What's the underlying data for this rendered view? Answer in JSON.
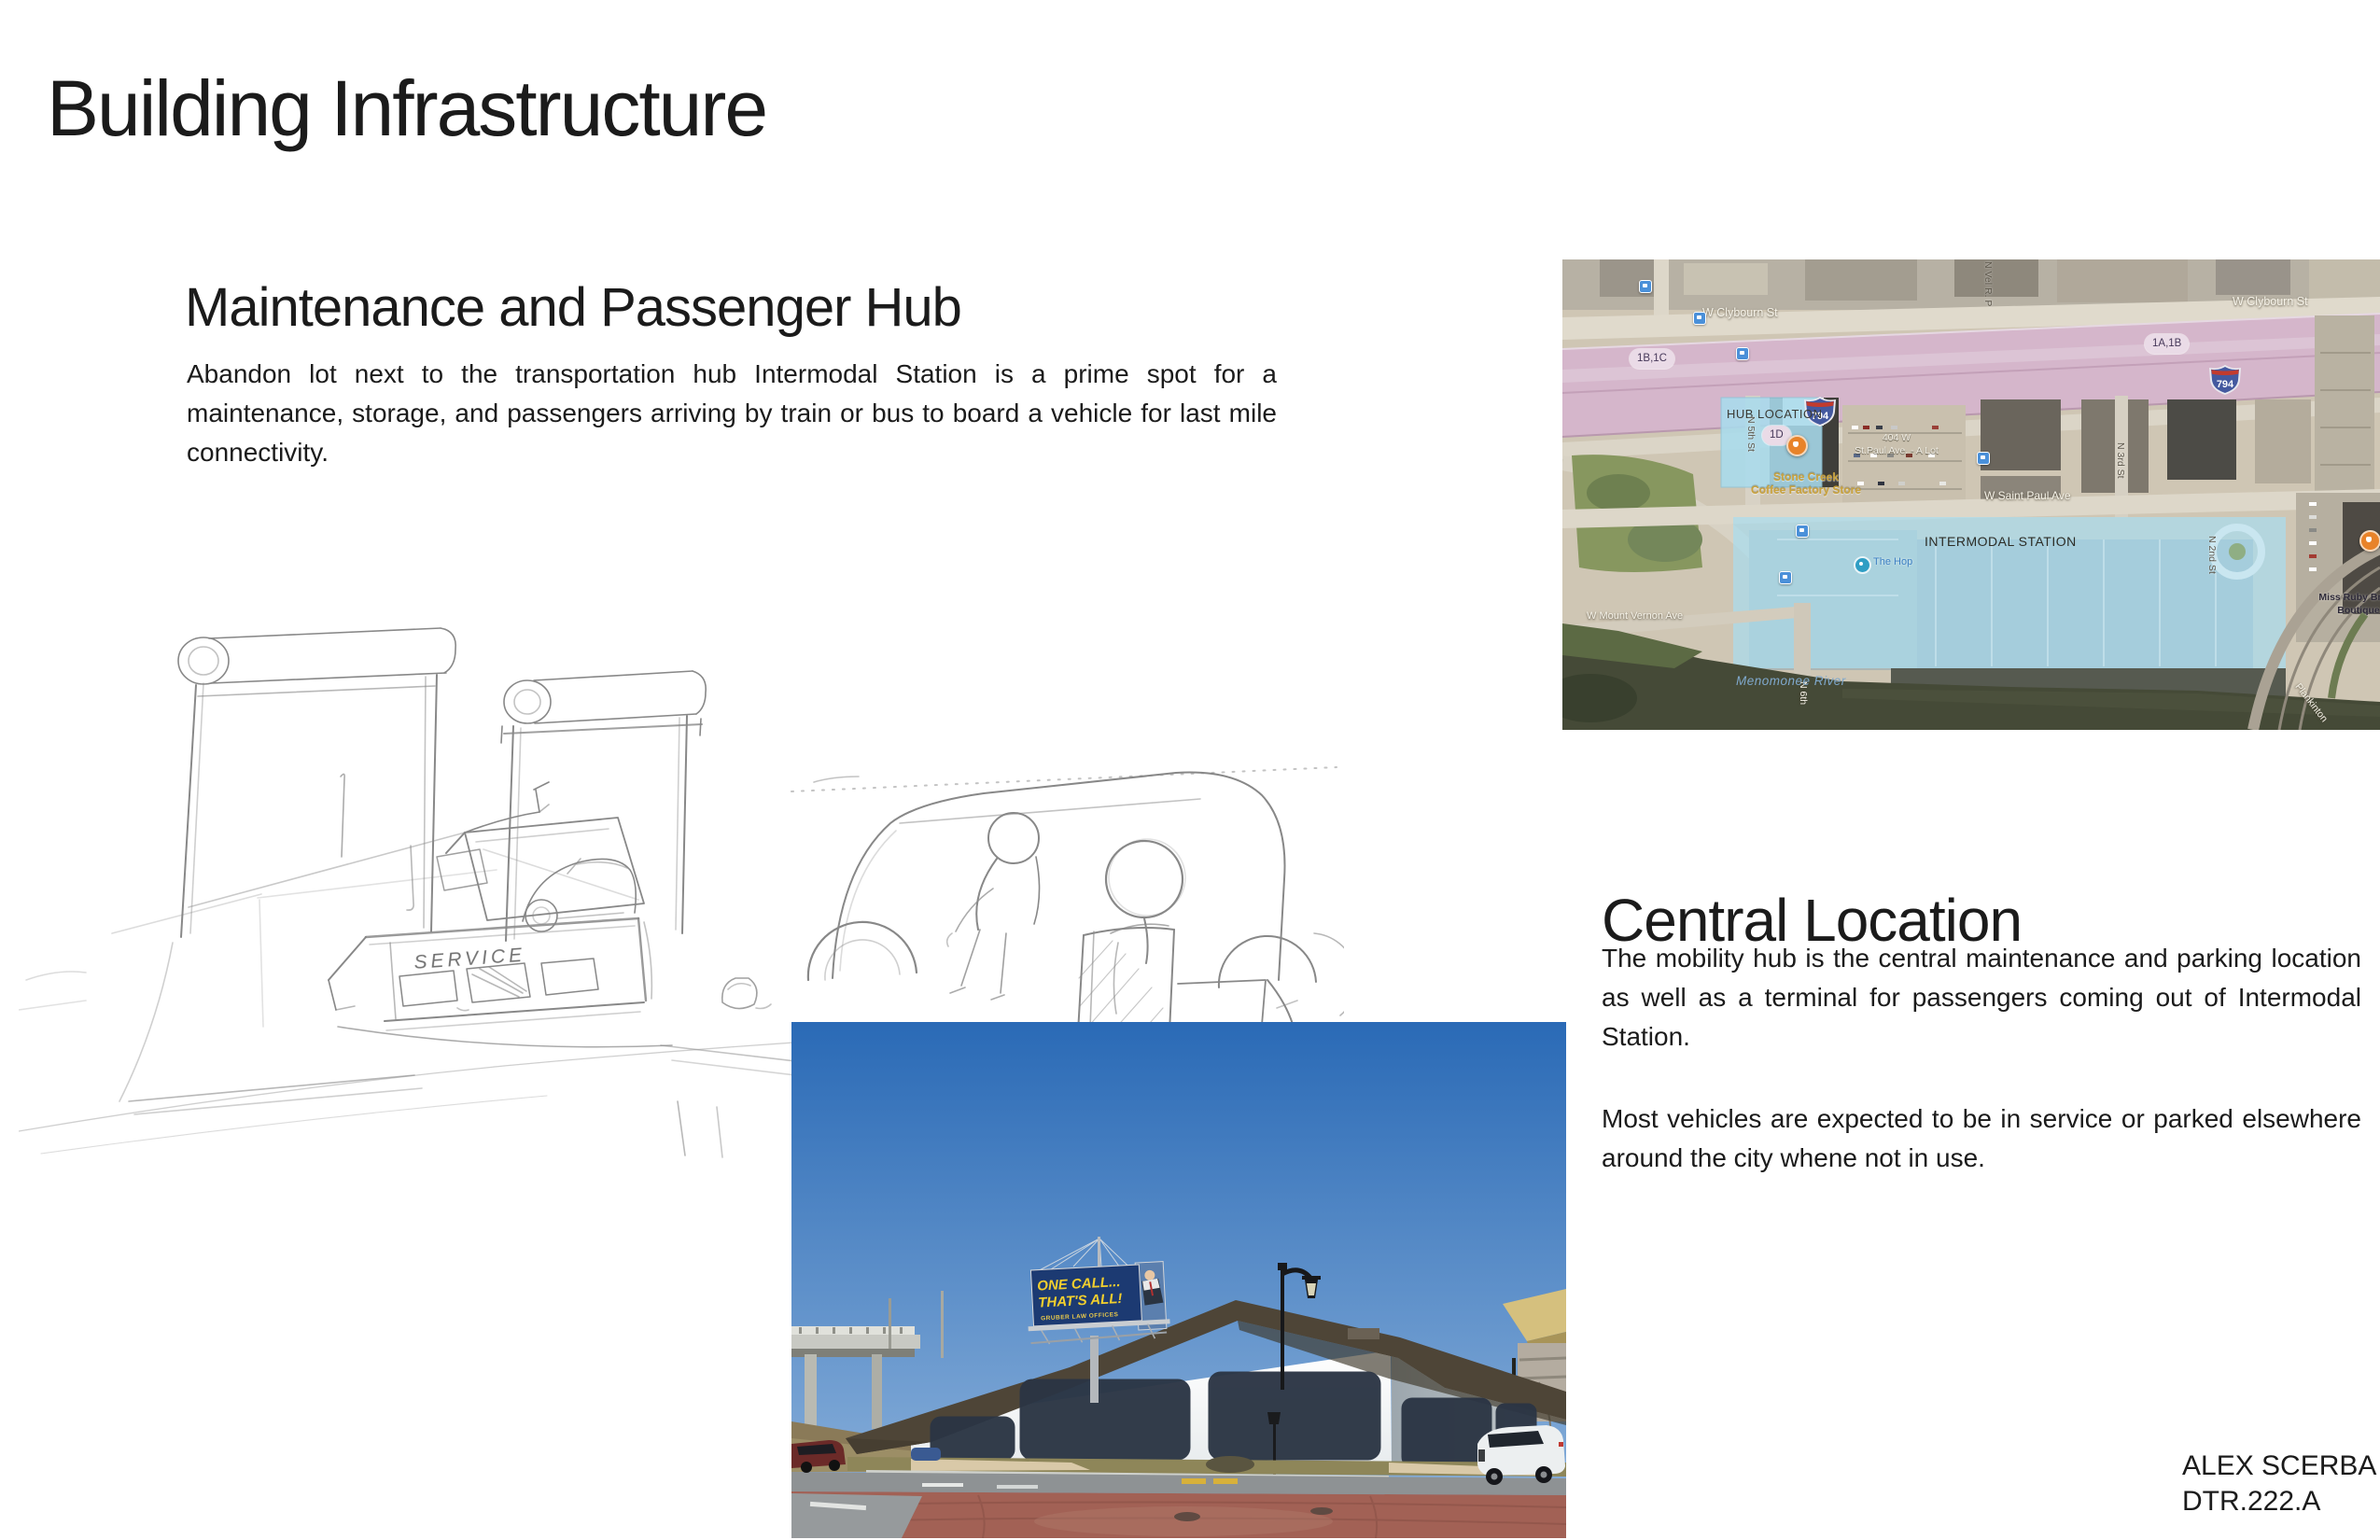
{
  "page": {
    "title": "Building Infrastructure",
    "credit_name": "ALEX SCERBA",
    "credit_id": "DTR.222.A"
  },
  "hub_section": {
    "heading": "Maintenance and Passenger Hub",
    "body": "Abandon lot next to the transportation hub Intermodal Station is a prime spot for a maintenance, storage, and passengers arriving by train or bus to board a vehicle for last mile connectivity."
  },
  "central_section": {
    "heading": "Central Location",
    "para1": "The mobility hub is the central maintenance and parking location as well as a terminal for passengers coming out of Intermodal Station.",
    "para2": "Most vehicles are expected to be in service or parked elsewhere around the city whene not in use."
  },
  "sketch": {
    "service_label": "SERVICE"
  },
  "map": {
    "streets": {
      "clybourn_left": "W Clybourn St",
      "clybourn_right": "W Clybourn St",
      "saint_paul": "W Saint Paul Ave",
      "mount_vernon": "W Mount Vernon Ave",
      "n5th": "N 5th St",
      "n3rd": "N 3rd St",
      "n2nd": "N 2nd St",
      "n6th": "N 6th",
      "n_vel": "N Vel R. P",
      "plankinton": "Plankinton"
    },
    "exits": {
      "left": "1B,1C",
      "mid": "1D",
      "right": "1A,1B"
    },
    "interstate": "794",
    "overlays": {
      "hub": "HUB LOCATION",
      "intermodal": "INTERMODAL STATION"
    },
    "pois": {
      "stone_creek_1": "Stone Creek",
      "stone_creek_2": "Coffee Factory Store",
      "lot_1": "404 W",
      "lot_2": "St.Paul Ave. - A Lot",
      "the_hop": "The Hop",
      "boutique_1": "Miss Ruby Bridal",
      "boutique_2": "Boutique",
      "river": "Menomonee River"
    }
  },
  "photo": {
    "billboard_line1": "ONE CALL...",
    "billboard_line2": "THAT'S ALL!",
    "billboard_line3": "GRUBER LAW OFFICES"
  },
  "colors": {
    "overlay_blue": "#a9dcee",
    "freeway_pink": "#d5b6cb",
    "billboard_blue": "#1c3a72",
    "billboard_yellow": "#f2cf2e",
    "roof_brown": "#4e4537",
    "window_navy": "#2b3544",
    "brick_red": "#a26155"
  }
}
